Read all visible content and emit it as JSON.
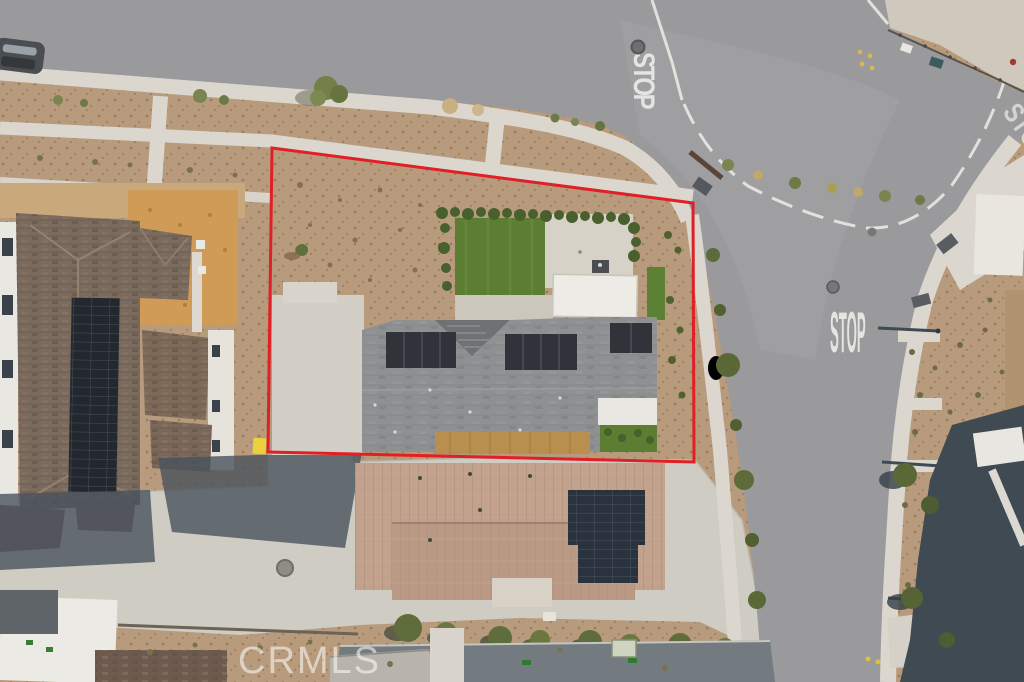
{
  "scene": {
    "type": "aerial-drone-photo",
    "subject": "corner residential lot outlined in red at a street intersection"
  },
  "road_markings": {
    "stop_top": "STOP",
    "stop_right": "STOP",
    "stop_top_right": "STOP"
  },
  "watermark": {
    "text": "CRMLS"
  },
  "colors": {
    "boundary_red": "#e01f26",
    "asphalt": "#9a999c",
    "concrete": "#d9d5cc",
    "dirt": "#b79b7c",
    "orange_dirt": "#d09b56",
    "lawn_green": "#5c7e33",
    "hedge_green": "#49602e",
    "solar_panel": "#2a323d",
    "gray_roof": "#8e9092",
    "tan_roof": "#c3a28d",
    "brown_roof": "#7b6a5e",
    "shadow": "#49535d",
    "watermark_white": "#ffffff"
  }
}
